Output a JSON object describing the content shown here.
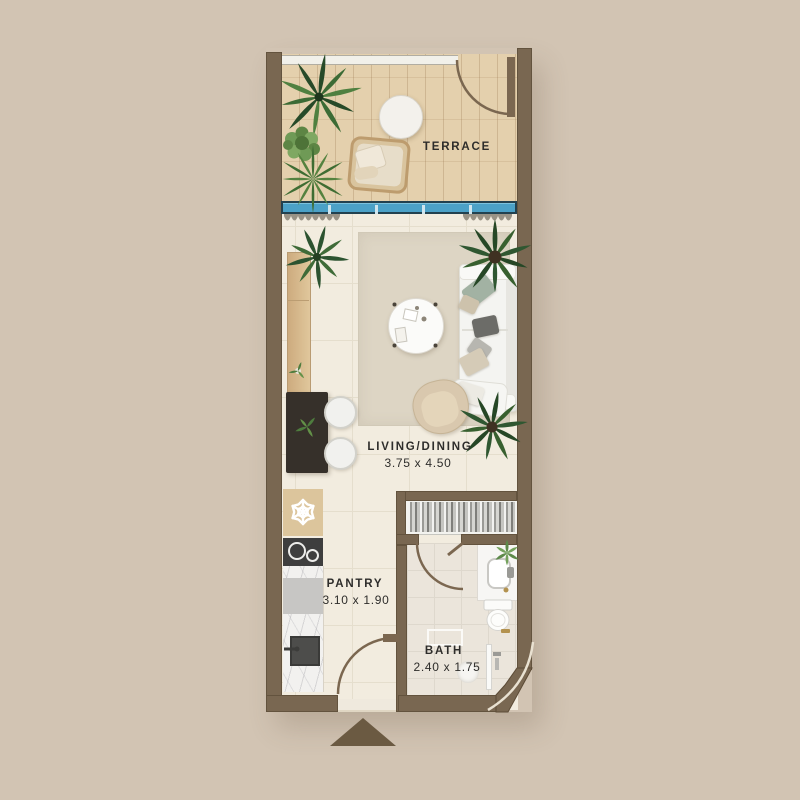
{
  "plan": {
    "rooms": {
      "terrace": {
        "label": "TERRACE"
      },
      "living_dining": {
        "label": "LIVING/DINING",
        "dimensions": "3.75 x 4.50"
      },
      "pantry": {
        "label": "PANTRY",
        "dimensions": "3.10 x 1.90"
      },
      "bath": {
        "label": "BATH",
        "dimensions": "2.40 x 1.75"
      }
    },
    "icons": {
      "fridge": "snowflake-icon",
      "entry": "up-triangle-arrow"
    },
    "colors": {
      "background": "#d2c4b3",
      "wall": "#796751",
      "window_glass": "#4ba1c7",
      "terrace_floor": "#e4d0ad",
      "interior_floor": "#f2ecdf",
      "rug": "#ddd5c4",
      "entry_arrow": "#6b5a42",
      "label_text": "#2e2d2b"
    }
  }
}
